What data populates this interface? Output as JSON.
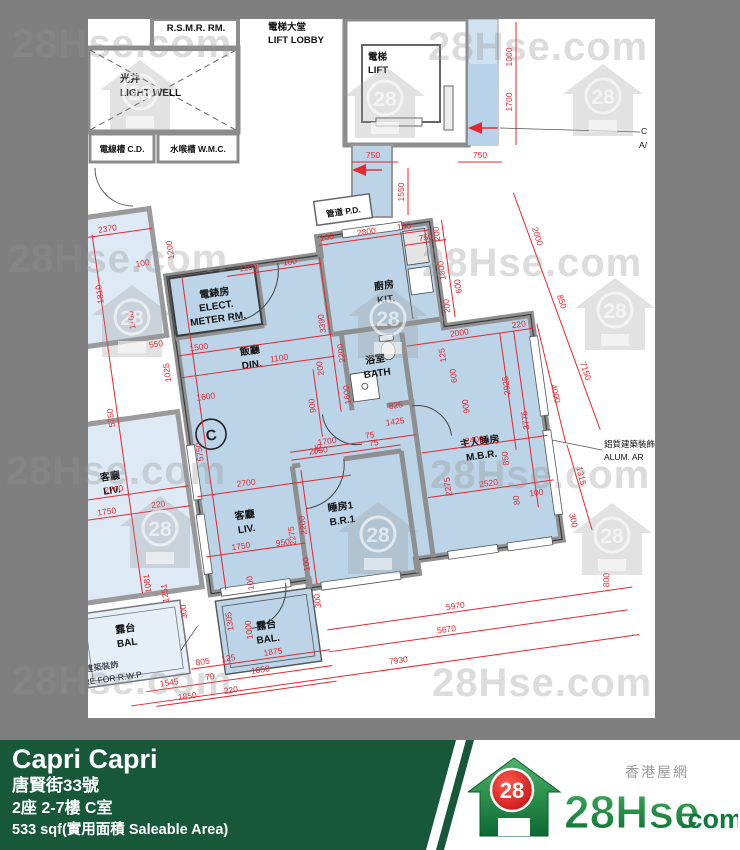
{
  "watermark": {
    "text": "28Hse.com",
    "number": "28"
  },
  "plan": {
    "unit_marker": "C",
    "rooms": {
      "light_well": {
        "zh": "光井",
        "en": "LIGHT WELL"
      },
      "rsmr": {
        "en": "R.S.M.R. RM."
      },
      "cd": {
        "label": "電線槽 C.D."
      },
      "wmc": {
        "label": "水喉槽 W.M.C."
      },
      "lift_lobby": {
        "zh": "電梯大堂",
        "en": "LIFT LOBBY"
      },
      "lift": {
        "zh": "電梯",
        "en": "LIFT"
      },
      "pd": {
        "label": "管道 P.D."
      },
      "elect": {
        "zh": "電錶房",
        "en1": "ELECT.",
        "en2": "METER RM."
      },
      "din": {
        "zh": "飯廳",
        "en": "DIN."
      },
      "kit": {
        "zh": "廚房",
        "en": "KIT."
      },
      "bath": {
        "zh": "浴室",
        "en": "BATH"
      },
      "liv": {
        "zh": "客廳",
        "en": "LIV."
      },
      "br1": {
        "zh": "睡房1",
        "en": "B.R.1"
      },
      "mbr": {
        "zh": "主人睡房",
        "en": "M.B.R."
      },
      "bal": {
        "zh": "露台",
        "en": "BAL."
      },
      "adj_liv": {
        "zh": "客廳",
        "en": "LIV."
      },
      "adj_bal": {
        "zh": "露台",
        "en": "BAL"
      }
    },
    "annotations": {
      "alum_zh": "鋁質建築裝飾",
      "alum_en": "ALUM. AR",
      "rwp_zh": "之建築裝飾",
      "rwp_en": "TURE FOR R.W.P.",
      "corner_line1": "C",
      "corner_line2": "A/"
    },
    "dims": [
      "2370",
      "1810",
      "100",
      "1200",
      "1100",
      "550",
      "1025",
      "1500",
      "1600",
      "1100",
      "100",
      "1100",
      "200",
      "3390",
      "2200",
      "1600",
      "100",
      "2800",
      "150",
      "750",
      "200",
      "600",
      "1800",
      "200",
      "2000",
      "220",
      "125",
      "600",
      "900",
      "2925",
      "3775",
      "2400",
      "2520",
      "850",
      "80",
      "100",
      "2275",
      "2050",
      "75",
      "2200",
      "2275",
      "950",
      "100",
      "300",
      "1700",
      "75",
      "825",
      "1425",
      "900",
      "75",
      "2700",
      "1750",
      "220",
      "5750",
      "5750",
      "2700",
      "1750",
      "100",
      "1305",
      "1000",
      "1081",
      "1251",
      "300",
      "805",
      "125",
      "1875",
      "1545",
      "70",
      "1850",
      "1850",
      "220",
      "5970",
      "800",
      "5670",
      "7930",
      "2000",
      "850",
      "7150",
      "4000",
      "1315",
      "300",
      "750",
      "750",
      "1550",
      "1000",
      "1700"
    ]
  },
  "footer": {
    "title": "Capri Capri",
    "address": "唐賢街33號",
    "unit": "2座 2-7樓 C室",
    "area": "533 sqf(實用面積 Saleable Area)",
    "site_name": "香港屋網",
    "logo": {
      "number": "28",
      "text": "28Hse",
      "suffix": ".com"
    }
  },
  "colors": {
    "dim_red": "#e8262e",
    "unit_blue": "#bcd4e8",
    "adjacent_blue": "#dde9f4",
    "border_gray": "#7f7f7f",
    "footer_green": "#17573a",
    "logo_red": "#d6150f",
    "logo_green": "#1d8a44"
  }
}
